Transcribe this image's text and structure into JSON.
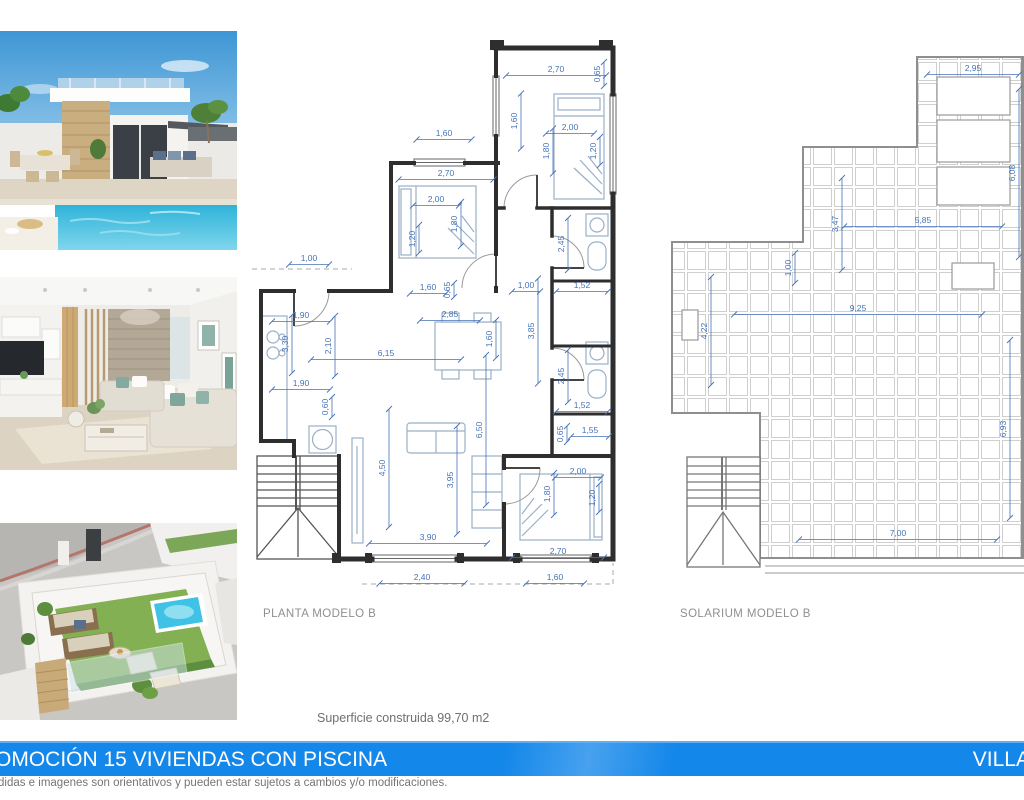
{
  "photos": {
    "villa": {
      "alt": "villa exterior with private pool"
    },
    "living": {
      "alt": "living room interior render"
    },
    "roof": {
      "alt": "aerial view of rooftop solarium terrace"
    }
  },
  "floor_plan": {
    "label": "PLANTA MODELO B",
    "dimensions": [
      {
        "t": "2,70",
        "x": 304,
        "y": 36,
        "rot": 0,
        "len": 100
      },
      {
        "t": "0,65",
        "x": 348,
        "y": 38,
        "rot": -90,
        "len": 24
      },
      {
        "t": "1,60",
        "x": 265,
        "y": 85,
        "rot": -90,
        "len": 55
      },
      {
        "t": "2,00",
        "x": 318,
        "y": 94,
        "rot": 0,
        "len": 48
      },
      {
        "t": "1,80",
        "x": 297,
        "y": 115,
        "rot": -90,
        "len": 45
      },
      {
        "t": "1,20",
        "x": 344,
        "y": 115,
        "rot": -90,
        "len": 28
      },
      {
        "t": "1,60",
        "x": 192,
        "y": 100,
        "rot": 0,
        "len": 55
      },
      {
        "t": "2,70",
        "x": 194,
        "y": 140,
        "rot": 0,
        "len": 95
      },
      {
        "t": "2,00",
        "x": 184,
        "y": 166,
        "rot": 0,
        "len": 46
      },
      {
        "t": "1,80",
        "x": 205,
        "y": 188,
        "rot": -90,
        "len": 44
      },
      {
        "t": "1,20",
        "x": 163,
        "y": 203,
        "rot": -90,
        "len": 28
      },
      {
        "t": "1,00",
        "x": 57,
        "y": 225,
        "rot": 0,
        "len": 40
      },
      {
        "t": "2,45",
        "x": 312,
        "y": 208,
        "rot": -90,
        "len": 52
      },
      {
        "t": "1,52",
        "x": 330,
        "y": 252,
        "rot": 0,
        "len": 52
      },
      {
        "t": "1,00",
        "x": 274,
        "y": 252,
        "rot": 0,
        "len": 28
      },
      {
        "t": "1,60",
        "x": 176,
        "y": 254,
        "rot": 0,
        "len": 36
      },
      {
        "t": "0,65",
        "x": 198,
        "y": 254,
        "rot": -90,
        "len": 14
      },
      {
        "t": "2,85",
        "x": 198,
        "y": 281,
        "rot": 0,
        "len": 60
      },
      {
        "t": "1,90",
        "x": 49,
        "y": 282,
        "rot": 0,
        "len": 58
      },
      {
        "t": "3,30",
        "x": 36,
        "y": 308,
        "rot": -90,
        "len": 58
      },
      {
        "t": "2,10",
        "x": 79,
        "y": 310,
        "rot": -90,
        "len": 60
      },
      {
        "t": "6,15",
        "x": 134,
        "y": 320,
        "rot": 0,
        "len": 150
      },
      {
        "t": "1,60",
        "x": 240,
        "y": 303,
        "rot": -90,
        "len": 38
      },
      {
        "t": "3,85",
        "x": 282,
        "y": 295,
        "rot": -90,
        "len": 105
      },
      {
        "t": "1,90",
        "x": 49,
        "y": 350,
        "rot": 0,
        "len": 58
      },
      {
        "t": "0,60",
        "x": 76,
        "y": 371,
        "rot": -90,
        "len": 20
      },
      {
        "t": "2,45",
        "x": 312,
        "y": 340,
        "rot": -90,
        "len": 52
      },
      {
        "t": "1,52",
        "x": 330,
        "y": 372,
        "rot": 0,
        "len": 52
      },
      {
        "t": "0,65",
        "x": 311,
        "y": 398,
        "rot": -90,
        "len": 16
      },
      {
        "t": "1,55",
        "x": 338,
        "y": 397,
        "rot": 0,
        "len": 38
      },
      {
        "t": "6,50",
        "x": 230,
        "y": 394,
        "rot": -90,
        "len": 150
      },
      {
        "t": "4,50",
        "x": 133,
        "y": 432,
        "rot": -90,
        "len": 118
      },
      {
        "t": "3,95",
        "x": 201,
        "y": 444,
        "rot": -90,
        "len": 108
      },
      {
        "t": "2,00",
        "x": 326,
        "y": 438,
        "rot": 0,
        "len": 46
      },
      {
        "t": "1,80",
        "x": 298,
        "y": 458,
        "rot": -90,
        "len": 42
      },
      {
        "t": "1,20",
        "x": 343,
        "y": 462,
        "rot": -90,
        "len": 28
      },
      {
        "t": "3,90",
        "x": 176,
        "y": 504,
        "rot": 0,
        "len": 118
      },
      {
        "t": "2,70",
        "x": 306,
        "y": 518,
        "rot": 0,
        "len": 92
      },
      {
        "t": "2,40",
        "x": 170,
        "y": 544,
        "rot": 0,
        "len": 85
      },
      {
        "t": "1,60",
        "x": 303,
        "y": 544,
        "rot": 0,
        "len": 58
      }
    ]
  },
  "solarium_plan": {
    "label": "SOLARIUM MODELO B",
    "dimensions": [
      {
        "t": "2,95",
        "x": 308,
        "y": 31,
        "rot": 0,
        "len": 92
      },
      {
        "t": "6,08",
        "x": 350,
        "y": 133,
        "rot": -90,
        "len": 168
      },
      {
        "t": "3,47",
        "x": 173,
        "y": 184,
        "rot": -90,
        "len": 92
      },
      {
        "t": "5,85",
        "x": 258,
        "y": 183,
        "rot": 0,
        "len": 158
      },
      {
        "t": "1,00",
        "x": 126,
        "y": 228,
        "rot": -90,
        "len": 30
      },
      {
        "t": "9,25",
        "x": 193,
        "y": 271,
        "rot": 0,
        "len": 248
      },
      {
        "t": "4,22",
        "x": 42,
        "y": 291,
        "rot": -90,
        "len": 108
      },
      {
        "t": "6,93",
        "x": 341,
        "y": 389,
        "rot": -90,
        "len": 178
      },
      {
        "t": "7,00",
        "x": 233,
        "y": 496,
        "rot": 0,
        "len": 198
      }
    ]
  },
  "surface_note": "Superficie construida 99,70 m2",
  "banner": {
    "left_text": "OMOCIÓN 15 VIVIENDAS CON PISCINA",
    "right_text": "VILLA"
  },
  "disclaimer": "didas e imagenes son orientativos y pueden estar sujetos a cambios y/o modificaciones.",
  "colors": {
    "banner_bg": "#1487ea",
    "dim": "#4472b8",
    "wall": "#2e2e2e",
    "furniture": "#9ab0c8",
    "tile": "#cfcfcf",
    "label": "#8f8f8f",
    "pool": "#35b5dc",
    "grass": "#84b054"
  }
}
